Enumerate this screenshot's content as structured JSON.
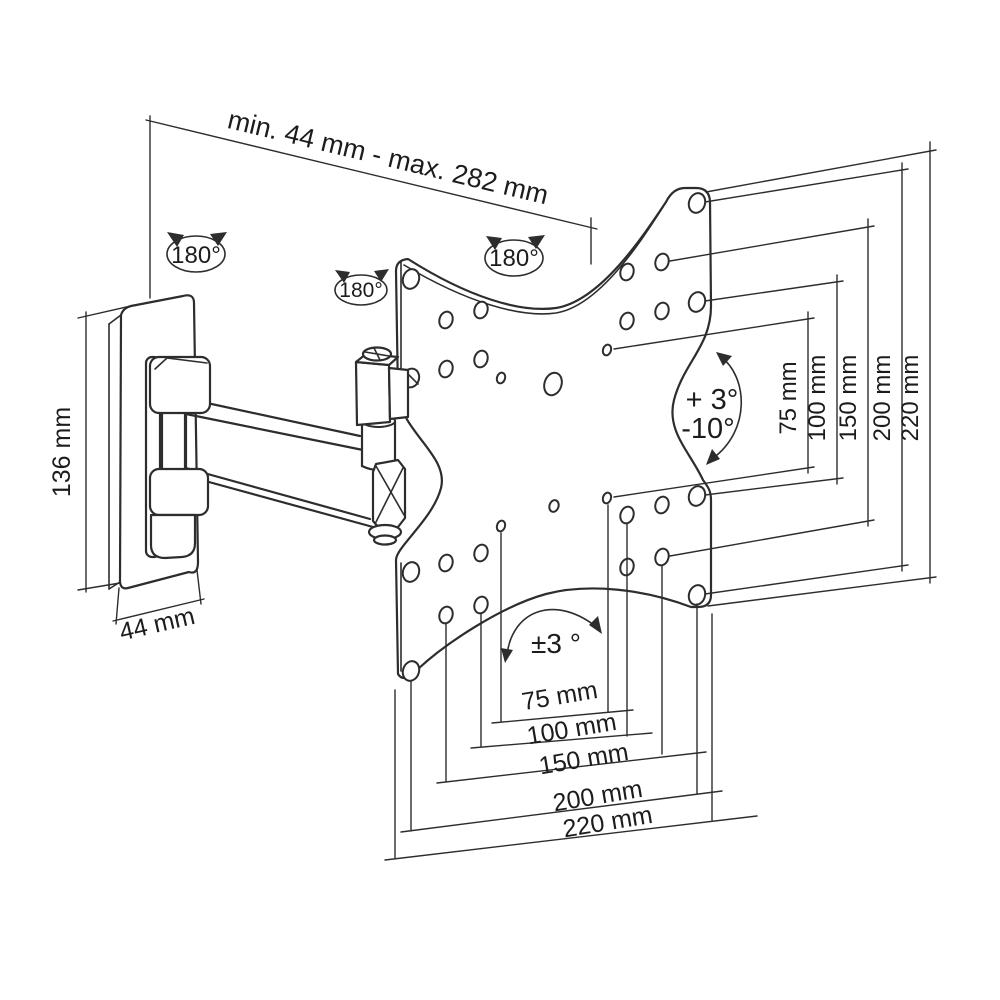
{
  "diagram": {
    "top_dimension": {
      "label": "min. 44 mm - max. 282 mm"
    },
    "wall_plate": {
      "height_label": "136 mm",
      "width_label": "44 mm"
    },
    "swivel": {
      "wall_label": "180°",
      "arm_label": "180°",
      "plate_label": "180°"
    },
    "tilt": {
      "up_label": "+ 3°",
      "down_label": "-10°"
    },
    "level_adjust": {
      "label": "±3 °"
    },
    "vesa_vertical": [
      {
        "label": "75 mm"
      },
      {
        "label": "100 mm"
      },
      {
        "label": "150 mm"
      },
      {
        "label": "200 mm"
      },
      {
        "label": "220 mm"
      }
    ],
    "vesa_horizontal": [
      {
        "label": "75 mm"
      },
      {
        "label": "100 mm"
      },
      {
        "label": "150 mm"
      },
      {
        "label": "200 mm"
      },
      {
        "label": "220 mm"
      }
    ]
  },
  "colors": {
    "line": "#2d2d2d",
    "background": "#ffffff"
  }
}
